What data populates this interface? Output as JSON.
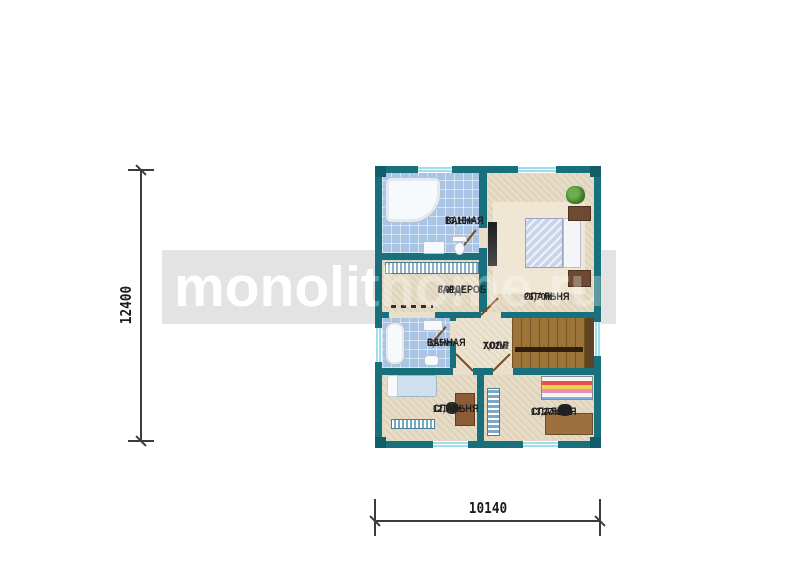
{
  "watermark": {
    "text": "monolithome.ru",
    "band_color": "#e3e3e3",
    "text_color": "#ffffff"
  },
  "dimensions": {
    "vertical": "12400",
    "horizontal": "10140"
  },
  "rooms": [
    {
      "name": "ВАННАЯ",
      "area": "13,16м²"
    },
    {
      "name": "ГАРДЕРОБ",
      "area": "8,91м²"
    },
    {
      "name": "СПАЛЬНЯ",
      "area": "26,70м²"
    },
    {
      "name": "ВАННАЯ",
      "area": "6,55м²"
    },
    {
      "name": "ХОЛЛ",
      "area": "7,02м²"
    },
    {
      "name": "СПАЛЬНЯ",
      "area": "12,74м²"
    },
    {
      "name": "СПАЛЬНЯ",
      "area": "13,27м²"
    }
  ],
  "colors": {
    "wall": "#17707c",
    "tile_floor": "#aac4e6",
    "wood_floor": "#e7dcc6",
    "stairs_wood": "#9c7339",
    "watermark_band": "#e3e3e3",
    "dimension_line": "#3c3c3c"
  }
}
